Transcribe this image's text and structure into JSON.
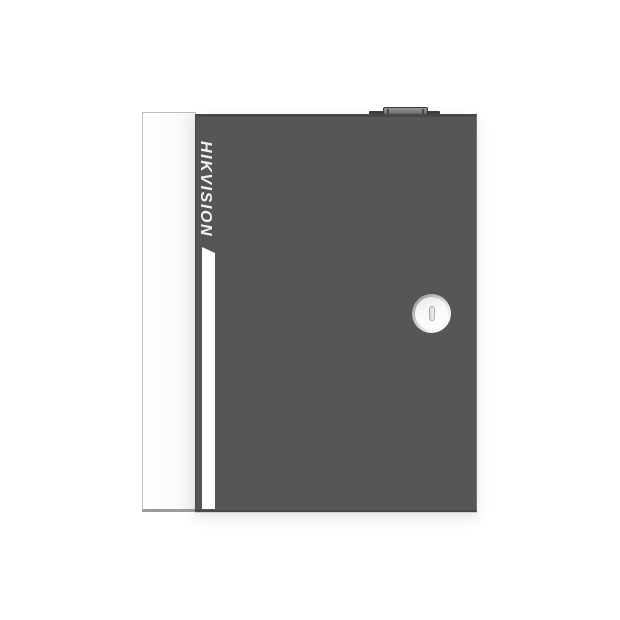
{
  "image": {
    "kind": "product-photo",
    "subject": "wall-mount metal enclosure with key lock on plain white background",
    "background_color": "#ffffff"
  },
  "device": {
    "brand_text": "HIKVISION",
    "parts": {
      "side_panel": "white side panel on left edge",
      "door": "dark grey front door",
      "accent_stripe": "white vertical accent stripe",
      "top_knob": "small raised knob on top edge",
      "lock": "round cam lock with vertical keyhole slot"
    },
    "colors": {
      "door_gray": "#565658",
      "door_edge_dark": "#48484a",
      "side_panel_white": "#fbfbfb",
      "stripe_white": "#fdfdfd",
      "knob_gray": "#8f8f91",
      "knob_base_dark": "#3e3e40",
      "lock_ring_gray": "#97979b",
      "lock_face_white": "#ffffff",
      "keyhole_gray": "#e9e9eb",
      "brand_text_color": "#f2f2f2"
    }
  }
}
